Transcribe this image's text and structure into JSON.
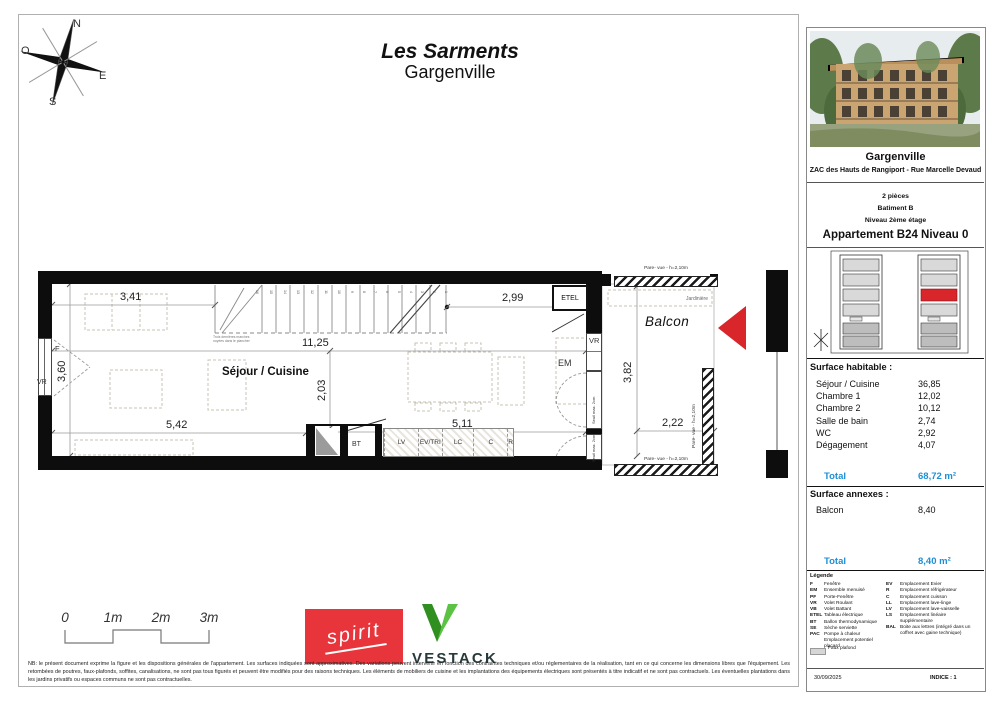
{
  "page": {
    "title1": "Les Sarments",
    "title2": "Gargenville"
  },
  "colors": {
    "blue": "#1e8fd5",
    "red": "#d8262b",
    "spirit": "#e8353b",
    "green": "#4cae32"
  },
  "compass": {
    "n": "N",
    "e": "E",
    "s": "S",
    "o": "O"
  },
  "plan": {
    "room": "Séjour / Cuisine",
    "balcony": "Balcon",
    "etel": "ETEL",
    "vr": "VR",
    "f": "F",
    "em": "EM",
    "bt": "BT",
    "seuil": "Seuil max. 2cm",
    "parevue": "Pare- vue - h=2,10m",
    "jardiniere": "Jardinière",
    "stair_note": "Trois dernières marches noyées dans le plancher",
    "kitchen": [
      "LV",
      "EV/TRI",
      "LC",
      "C",
      "R"
    ],
    "stair_numbers": [
      "16",
      "15",
      "14",
      "13",
      "12",
      "11",
      "10",
      "9",
      "8",
      "7",
      "6",
      "5",
      "4",
      "3",
      "2",
      "1"
    ],
    "dims": {
      "d341": "3,41",
      "d299": "2,99",
      "d1125": "11,25",
      "d360": "3,60",
      "d203": "2,03",
      "d542": "5,42",
      "d511": "5,11",
      "d382": "3,82",
      "d222": "2,22"
    }
  },
  "scalebar": {
    "labels": [
      "0",
      "1m",
      "2m",
      "3m"
    ]
  },
  "logos": {
    "spirit": "spirit",
    "vestack": "VESTACK"
  },
  "disclaimer": {
    "text": "NB: le présent document exprime la figure et les dispositions générales de l'appartement. Les surfaces indiquées sont approximatives. Des variations peuvent intervenir en fonction des contraintes techniques et/ou réglementaires de la réalisation, tant en ce qui concerne les dimensions libres que l'équipement. Les retombées de poutres, faux-plafonds, soffites, canalisations, ne sont pas tous figurés et peuvent être modifiés pour des raisons techniques. Les éléments de mobiliers de cuisine et les implantations des équipements électriques sont présentés à titre indicatif et ne sont pas contractuels. Les éventuelles plantations dans les jardins privatifs ou espaces communs ne sont pas contractuelles."
  },
  "sidebar": {
    "project": {
      "name": "Gargenville",
      "address": "ZAC des Hauts de Rangiport - Rue Marcelle Devaud"
    },
    "unit": {
      "rooms": "2 pièces",
      "building": "Batiment B",
      "level": "Niveau 2ème étage",
      "apartment": "Appartement B24 Niveau 0"
    },
    "surface_habitable": {
      "title": "Surface habitable :",
      "rows": [
        {
          "label": "Séjour / Cuisine",
          "value": "36,85"
        },
        {
          "label": "Chambre 1",
          "value": "12,02"
        },
        {
          "label": "Chambre 2",
          "value": "10,12"
        },
        {
          "label": "Salle de bain",
          "value": "2,74"
        },
        {
          "label": "WC",
          "value": "2,92"
        },
        {
          "label": "Dégagement",
          "value": "4,07"
        }
      ],
      "total_label": "Total",
      "total_value": "68,72 m²"
    },
    "surface_annexes": {
      "title": "Surface annexes :",
      "rows": [
        {
          "label": "Balcon",
          "value": "8,40"
        }
      ],
      "total_label": "Total",
      "total_value": "8,40 m²"
    },
    "legend": {
      "title": "Légende",
      "col1": [
        {
          "c": "F",
          "d": "Fenêtre"
        },
        {
          "c": "EM",
          "d": "Ensemble menuisé"
        },
        {
          "c": "PF",
          "d": "Porte-Fenêtre"
        },
        {
          "c": "VR",
          "d": "Volet Roulant"
        },
        {
          "c": "VB",
          "d": "Volet Battant"
        },
        {
          "c": "ETEL",
          "d": "Tableau électrique"
        },
        {
          "c": "BT",
          "d": "Ballon thermodynamique"
        },
        {
          "c": "SE",
          "d": "Sèche serviette"
        },
        {
          "c": "PAC",
          "d": "Pompe à chaleur"
        },
        {
          "c": "",
          "d": "Emplacement potentiel placard"
        }
      ],
      "col2": [
        {
          "c": "EV",
          "d": "Emplacement Evier"
        },
        {
          "c": "R",
          "d": "Emplacement réfrigérateur"
        },
        {
          "c": "C",
          "d": "Emplacement cuisson"
        },
        {
          "c": "LL",
          "d": "Emplacement lave-linge"
        },
        {
          "c": "LV",
          "d": "Emplacement lave-vaisselle"
        },
        {
          "c": "LS",
          "d": "Emplacement linéaire supplémentaire"
        },
        {
          "c": "BAL",
          "d": "Boite aux lettres (intégré dans un coffret avec gaine technique)"
        }
      ],
      "faux_plafond": "Faux plafond"
    },
    "footer": {
      "date": "30/09/2025",
      "indice": "INDICE : 1"
    }
  }
}
